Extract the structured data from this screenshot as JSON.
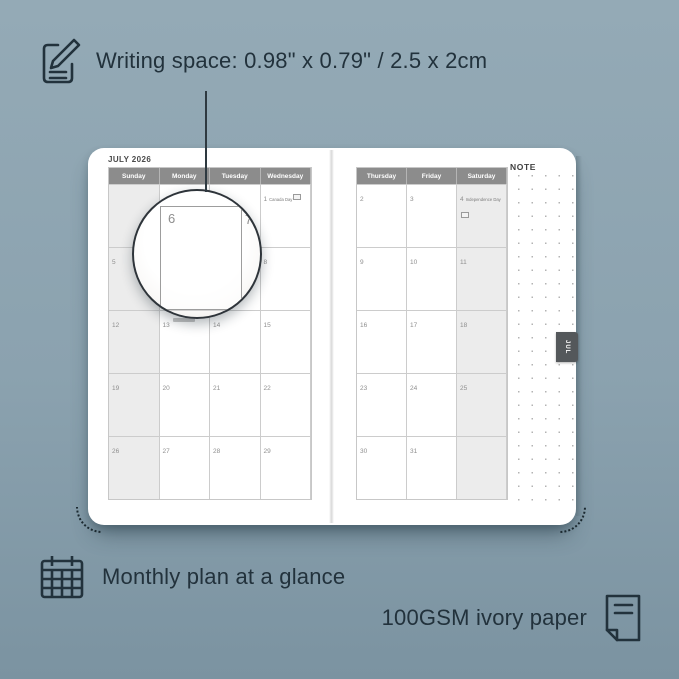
{
  "colors": {
    "background_top": "#94aab6",
    "background_bottom": "#7b93a1",
    "ink": "#22323c",
    "calendar_header_bg": "#8c8c8c",
    "weekend_shade": "#ececec",
    "tab_bg": "#54585b"
  },
  "features": {
    "writing_space": {
      "icon": "notepad-pencil-icon",
      "text": "Writing space: 0.98\" x 0.79\" / 2.5 x 2cm"
    },
    "monthly_plan": {
      "icon": "calendar-grid-icon",
      "text": "Monthly plan at a glance"
    },
    "paper": {
      "icon": "paper-sheet-icon",
      "text": "100GSM ivory paper"
    }
  },
  "planner": {
    "month_title": "JULY 2026",
    "side_tab": "JUL",
    "note_label": "NOTE",
    "left_page": {
      "headers": [
        "Sunday",
        "Monday",
        "Tuesday",
        "Wednesday"
      ],
      "rows": [
        [
          {
            "day": ""
          },
          {
            "day": ""
          },
          {
            "day": ""
          },
          {
            "day": "1",
            "holiday": "Canada Day",
            "flag": true
          }
        ],
        [
          {
            "day": "5"
          },
          {
            "day": "6"
          },
          {
            "day": "7"
          },
          {
            "day": "8"
          }
        ],
        [
          {
            "day": "12"
          },
          {
            "day": "13"
          },
          {
            "day": "14"
          },
          {
            "day": "15"
          }
        ],
        [
          {
            "day": "19"
          },
          {
            "day": "20"
          },
          {
            "day": "21"
          },
          {
            "day": "22"
          }
        ],
        [
          {
            "day": "26"
          },
          {
            "day": "27"
          },
          {
            "day": "28"
          },
          {
            "day": "29"
          }
        ]
      ]
    },
    "right_page": {
      "headers": [
        "Thursday",
        "Friday",
        "Saturday"
      ],
      "rows": [
        [
          {
            "day": "2"
          },
          {
            "day": "3"
          },
          {
            "day": "4",
            "holiday": "Independence Day",
            "flag": true
          }
        ],
        [
          {
            "day": "9"
          },
          {
            "day": "10"
          },
          {
            "day": "11"
          }
        ],
        [
          {
            "day": "16"
          },
          {
            "day": "17"
          },
          {
            "day": "18"
          }
        ],
        [
          {
            "day": "23"
          },
          {
            "day": "24"
          },
          {
            "day": "25"
          }
        ],
        [
          {
            "day": "30"
          },
          {
            "day": "31"
          },
          {
            "day": ""
          }
        ]
      ]
    }
  },
  "magnifier": {
    "zoomed_day": "6",
    "adjacent_day": "7"
  }
}
